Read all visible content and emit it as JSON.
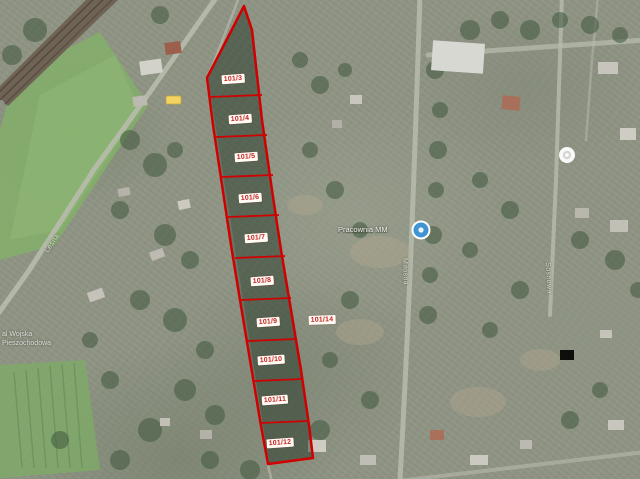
{
  "map": {
    "type": "satellite-map-with-cadastral-overlay",
    "parcel_labels": [
      "101/3",
      "101/4",
      "101/5",
      "101/6",
      "101/7",
      "101/8",
      "101/9",
      "101/10",
      "101/11",
      "101/12"
    ],
    "adjacent_parcel_label": "101/14",
    "poi_label": "Pracownia MM",
    "street_labels": {
      "left_road": "Leśna",
      "center_road": "Miłosna",
      "right_road": "Sosnowa"
    },
    "area_label": {
      "line1": "al Wojska",
      "line2": "Pieszochodowa"
    }
  },
  "colors": {
    "boundary": "#d10000",
    "parcel_label_text": "#c42020",
    "parcel_label_bg": "#fffcf5",
    "poi_blue": "#4094d4",
    "shield_yellow": "#f3d463",
    "field_green": "#84ad6b",
    "road_gray": "#b7bbad"
  }
}
